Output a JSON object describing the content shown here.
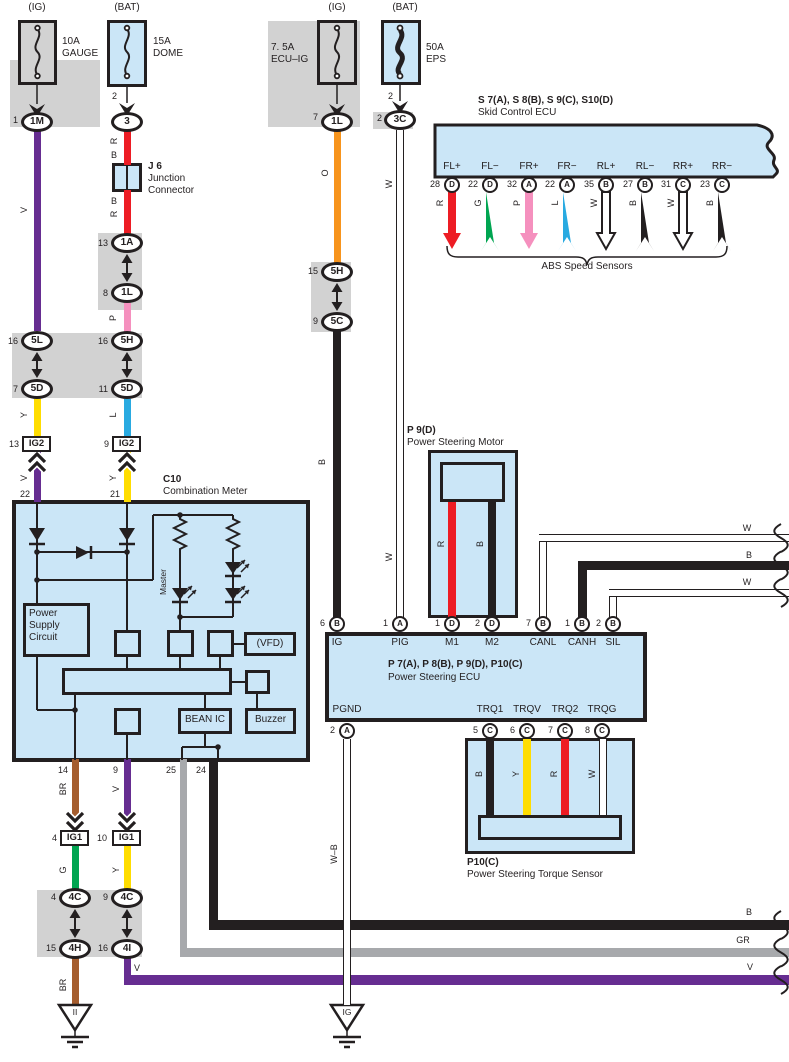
{
  "palette": {
    "ink": "#231f20",
    "blue": "#cbe6f7",
    "gray": "#d2d2d2",
    "v": "#662d91",
    "y": "#ffdd00",
    "l": "#29aae1",
    "r": "#ed1c24",
    "g": "#00a551",
    "p": "#f590be",
    "o": "#f7941d",
    "br": "#a55d2e",
    "gr": "#a7a9ac",
    "b": "#231f20",
    "w": "#ffffff"
  },
  "fuses": {
    "gauge": {
      "tap": "(IG)",
      "rating": "10A",
      "name": "GAUGE",
      "pin": "1",
      "connector": "1M"
    },
    "dome": {
      "tap": "(BAT)",
      "rating": "15A",
      "name": "DOME",
      "line_pin": "2",
      "connector": "3"
    },
    "ecu_ig": {
      "tap": "(IG)",
      "rating": "7. 5A",
      "name": "ECU–IG",
      "pin": "7",
      "connector": "1L"
    },
    "eps": {
      "tap": "(BAT)",
      "rating": "50A",
      "name": "EPS",
      "line_pin": "2",
      "pin": "2",
      "connector": "3C"
    }
  },
  "junction": {
    "id": "J 6",
    "line1": "Junction",
    "line2": "Connector",
    "above1": "R",
    "above2": "B",
    "below1": "B",
    "below2": "R"
  },
  "gauge_branch": {
    "wire1": "V",
    "c5l_no": "16",
    "c5l": "5L",
    "c5d_no": "7",
    "c5d": "5D",
    "wire2": "Y",
    "ig2_no": "13",
    "ig2": "IG2",
    "wire3": "V",
    "meter_pin": "22"
  },
  "dome_branch": {
    "c1a_no": "13",
    "c1a": "1A",
    "c1l_no": "8",
    "c1l": "1L",
    "wire_p": "P",
    "c5h_no": "16",
    "c5h": "5H",
    "c5d_no": "11",
    "c5d": "5D",
    "wire_l": "L",
    "ig2_no": "9",
    "ig2": "IG2",
    "wire_y": "Y",
    "meter_pin": "21"
  },
  "ecuig_branch": {
    "wire_o": "O",
    "c5h_no": "15",
    "c5h": "5H",
    "c5c_no": "9",
    "c5c": "5C",
    "wire_b": "B"
  },
  "eps_branch": {
    "wire_w1": "W",
    "wire_w2": "W"
  },
  "meter": {
    "ref": "C10",
    "name": "Combination Meter",
    "psc1": "Power",
    "psc2": "Supply",
    "psc3": "Circuit",
    "master": "Master",
    "vfd": "(VFD)",
    "bean": "BEAN IC",
    "buzzer": "Buzzer",
    "pin14": "14",
    "pin9": "9",
    "pin25": "25",
    "pin24": "24"
  },
  "ig1_left": {
    "wire_br1": "BR",
    "no": "4",
    "id": "IG1",
    "wire_g": "G",
    "c4c_no": "4",
    "c4c": "4C",
    "c4h_no": "15",
    "c4h": "4H",
    "wire_br2": "BR",
    "ground": "II"
  },
  "ig1_right": {
    "wire_v1": "V",
    "no": "10",
    "id": "IG1",
    "wire_y": "Y",
    "c4c_no": "9",
    "c4c": "4C",
    "c4i_no": "16",
    "c4i": "4I",
    "wire_v2": "V"
  },
  "skid_ecu": {
    "title": "S 7(A), S 8(B), S 9(C), S10(D)",
    "subtitle": "Skid Control ECU",
    "brace": "ABS Speed Sensors",
    "pins": [
      {
        "label": "FL+",
        "num": "28",
        "code": "D",
        "wire": "R",
        "color": "#ed1c24"
      },
      {
        "label": "FL−",
        "num": "22",
        "code": "D",
        "wire": "G",
        "color": "#00a551"
      },
      {
        "label": "FR+",
        "num": "32",
        "code": "A",
        "wire": "P",
        "color": "#f590be"
      },
      {
        "label": "FR−",
        "num": "22",
        "code": "A",
        "wire": "L",
        "color": "#29aae1"
      },
      {
        "label": "RL+",
        "num": "35",
        "code": "B",
        "wire": "W",
        "color": "#ffffff"
      },
      {
        "label": "RL−",
        "num": "27",
        "code": "B",
        "wire": "B",
        "color": "#231f20"
      },
      {
        "label": "RR+",
        "num": "31",
        "code": "C",
        "wire": "W",
        "color": "#ffffff"
      },
      {
        "label": "RR−",
        "num": "23",
        "code": "C",
        "wire": "B",
        "color": "#231f20"
      }
    ]
  },
  "motor": {
    "ref": "P 9(D)",
    "name": "Power Steering Motor",
    "wire_r": "R",
    "wire_b": "B"
  },
  "ps_ecu": {
    "ref": "P 7(A), P 8(B), P 9(D), P10(C)",
    "name": "Power Steering ECU",
    "top": [
      {
        "label": "IG",
        "num": "6",
        "code": "B"
      },
      {
        "label": "PIG",
        "num": "1",
        "code": "A"
      },
      {
        "label": "M1",
        "num": "1",
        "code": "D"
      },
      {
        "label": "M2",
        "num": "2",
        "code": "D"
      },
      {
        "label": "CANL",
        "num": "7",
        "code": "B"
      },
      {
        "label": "CANH",
        "num": "1",
        "code": "B"
      },
      {
        "label": "SIL",
        "num": "2",
        "code": "B"
      }
    ],
    "bottom": [
      {
        "label": "PGND",
        "num": "2",
        "code": "A"
      },
      {
        "label": "TRQ1",
        "num": "5",
        "code": "C"
      },
      {
        "label": "TRQV",
        "num": "6",
        "code": "C"
      },
      {
        "label": "TRQ2",
        "num": "7",
        "code": "C"
      },
      {
        "label": "TRQG",
        "num": "8",
        "code": "C"
      }
    ]
  },
  "can": {
    "canl": "W",
    "canh": "B",
    "sil": "W"
  },
  "sensor": {
    "ref": "P10(C)",
    "name": "Power Steering Torque Sensor",
    "w1": "B",
    "w2": "Y",
    "w3": "R",
    "w4": "W"
  },
  "pgnd": {
    "wire": "W–B",
    "ground": "IG"
  },
  "bottom_wires": {
    "v_near": "V",
    "b": "B",
    "gr": "GR",
    "v": "V"
  }
}
